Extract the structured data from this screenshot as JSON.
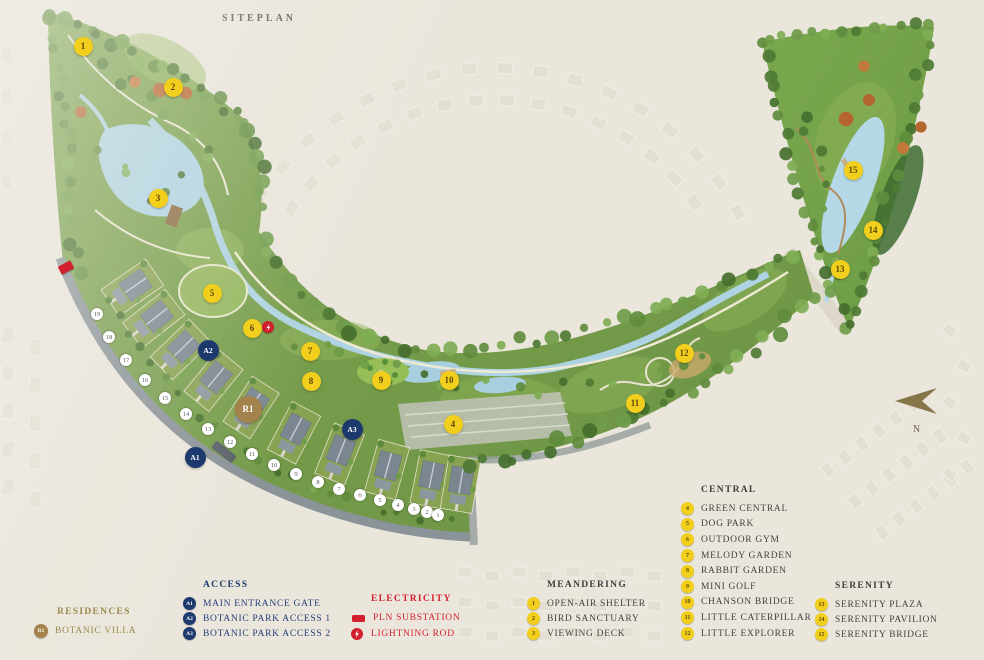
{
  "title": "SITEPLAN",
  "compass": {
    "label": "N"
  },
  "colors": {
    "marker_yellow": "#f2cf1c",
    "access_navy": "#1d3a6e",
    "electric_red": "#d3202f",
    "residence_gold": "#a3834b",
    "heading_dark": "#3b403d"
  },
  "legend": {
    "residences": {
      "header": "RESIDENCES",
      "items": [
        {
          "badge": "R1",
          "label": "BOTANIC VILLA"
        }
      ]
    },
    "access": {
      "header": "ACCESS",
      "items": [
        {
          "badge": "A1",
          "label": "MAIN ENTRANCE GATE"
        },
        {
          "badge": "A2",
          "label": "BOTANIC PARK ACCESS 1"
        },
        {
          "badge": "A3",
          "label": "BOTANIC PARK ACCESS 2"
        }
      ]
    },
    "electricity": {
      "header": "ELECTRICITY",
      "items": [
        {
          "icon": "substation-icon",
          "label": "PLN SUBSTATION"
        },
        {
          "icon": "lightning-icon",
          "label": "LIGHTNING ROD"
        }
      ]
    },
    "meandering": {
      "header": "MEANDERING",
      "items": [
        {
          "badge": "1",
          "label": "OPEN-AIR SHELTER"
        },
        {
          "badge": "2",
          "label": "BIRD SANCTUARY"
        },
        {
          "badge": "3",
          "label": "VIEWING DECK"
        }
      ]
    },
    "central": {
      "header": "CENTRAL",
      "items": [
        {
          "badge": "4",
          "label": "GREEN CENTRAL"
        },
        {
          "badge": "5",
          "label": "DOG PARK"
        },
        {
          "badge": "6",
          "label": "OUTDOOR GYM"
        },
        {
          "badge": "7",
          "label": "MELODY GARDEN"
        },
        {
          "badge": "8",
          "label": "RABBIT GARDEN"
        },
        {
          "badge": "9",
          "label": "MINI GOLF"
        },
        {
          "badge": "10",
          "label": "CHANSON BRIDGE"
        },
        {
          "badge": "11",
          "label": "LITTLE CATERPILLAR"
        },
        {
          "badge": "12",
          "label": "LITTLE EXPLORER"
        }
      ]
    },
    "serenity": {
      "header": "SERENITY",
      "items": [
        {
          "badge": "13",
          "label": "SERENITY PLAZA"
        },
        {
          "badge": "14",
          "label": "SERENITY PAVILION"
        },
        {
          "badge": "15",
          "label": "SERENITY BRIDGE"
        }
      ]
    }
  },
  "map": {
    "poi_markers": [
      {
        "n": "1",
        "x": 83,
        "y": 46
      },
      {
        "n": "2",
        "x": 173,
        "y": 87
      },
      {
        "n": "3",
        "x": 158,
        "y": 198
      },
      {
        "n": "4",
        "x": 453,
        "y": 424
      },
      {
        "n": "5",
        "x": 212,
        "y": 293
      },
      {
        "n": "6",
        "x": 252,
        "y": 328
      },
      {
        "n": "7",
        "x": 310,
        "y": 351
      },
      {
        "n": "8",
        "x": 311,
        "y": 381
      },
      {
        "n": "9",
        "x": 381,
        "y": 380
      },
      {
        "n": "10",
        "x": 449,
        "y": 380
      },
      {
        "n": "11",
        "x": 635,
        "y": 403
      },
      {
        "n": "12",
        "x": 684,
        "y": 353
      },
      {
        "n": "13",
        "x": 840,
        "y": 269
      },
      {
        "n": "14",
        "x": 873,
        "y": 230
      },
      {
        "n": "15",
        "x": 853,
        "y": 170
      }
    ],
    "access_markers": [
      {
        "n": "A1",
        "x": 195,
        "y": 457
      },
      {
        "n": "A2",
        "x": 208,
        "y": 350
      },
      {
        "n": "A3",
        "x": 352,
        "y": 429
      }
    ],
    "residence_markers": [
      {
        "n": "R1",
        "x": 248,
        "y": 409
      }
    ],
    "lot_markers": [
      {
        "n": "19",
        "x": 97,
        "y": 314
      },
      {
        "n": "18",
        "x": 109,
        "y": 337
      },
      {
        "n": "17",
        "x": 126,
        "y": 360
      },
      {
        "n": "16",
        "x": 145,
        "y": 380
      },
      {
        "n": "15",
        "x": 165,
        "y": 398
      },
      {
        "n": "14",
        "x": 186,
        "y": 414
      },
      {
        "n": "13",
        "x": 208,
        "y": 429
      },
      {
        "n": "12",
        "x": 230,
        "y": 442
      },
      {
        "n": "11",
        "x": 252,
        "y": 454
      },
      {
        "n": "10",
        "x": 274,
        "y": 465
      },
      {
        "n": "9",
        "x": 296,
        "y": 474
      },
      {
        "n": "8",
        "x": 318,
        "y": 482
      },
      {
        "n": "7",
        "x": 339,
        "y": 489
      },
      {
        "n": "6",
        "x": 360,
        "y": 495
      },
      {
        "n": "5",
        "x": 380,
        "y": 500
      },
      {
        "n": "4",
        "x": 398,
        "y": 505
      },
      {
        "n": "3",
        "x": 414,
        "y": 509
      },
      {
        "n": "2",
        "x": 427,
        "y": 512
      },
      {
        "n": "1",
        "x": 438,
        "y": 515
      }
    ],
    "electric_markers": [
      {
        "type": "substation",
        "x": 66,
        "y": 267
      },
      {
        "type": "lightning",
        "x": 268,
        "y": 327
      }
    ]
  }
}
